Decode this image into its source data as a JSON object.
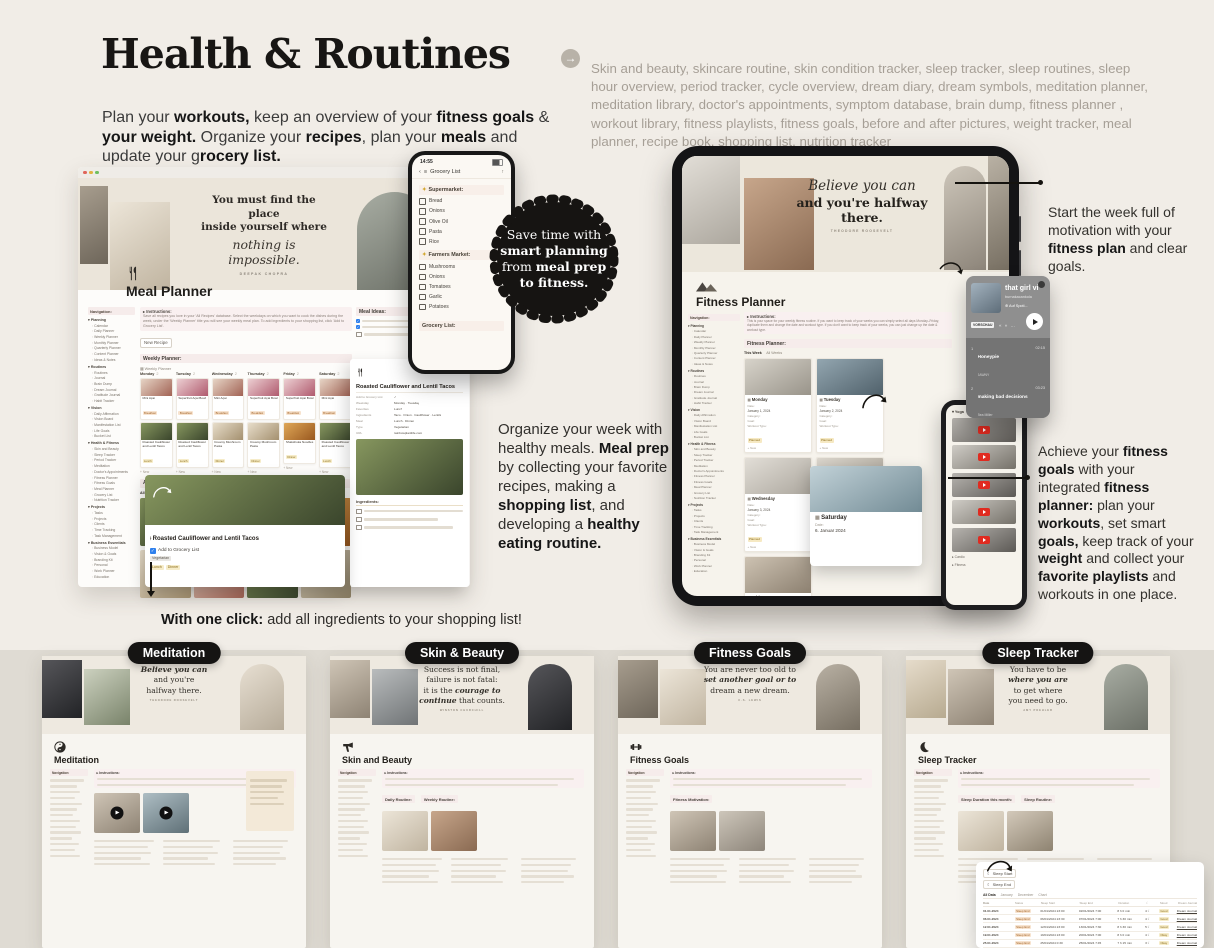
{
  "header": {
    "title": "Health & Routines",
    "arrow_icon": "→",
    "intro": [
      {
        "t": "Plan your ",
        "c": ""
      },
      {
        "t": "workouts,",
        "c": "b"
      },
      {
        "t": " keep an overview of your ",
        "c": ""
      },
      {
        "t": "fitness goals",
        "c": "b"
      },
      {
        "t": " & ",
        "c": ""
      },
      {
        "t": "your weight.",
        "c": "b"
      },
      {
        "t": " Organize your ",
        "c": ""
      },
      {
        "t": "recipes",
        "c": "b"
      },
      {
        "t": ", plan your ",
        "c": ""
      },
      {
        "t": "meals",
        "c": "b"
      },
      {
        "t": " and update your g",
        "c": ""
      },
      {
        "t": "rocery list.",
        "c": "b"
      }
    ],
    "features": "Skin and beauty, skincare routine, skin condition tracker, sleep tracker, sleep routines, sleep hour overview, period tracker, cycle overview, dream diary, dream symbols, meditation planner, meditation library, doctor's appointments, symptom database, brain dump, fitness planner , workout library, fitness playlists, fitness goals, before and after pictures, weight tracker, meal planner, recipe book, shopping list, nutrition tracker"
  },
  "badge": {
    "lines": [
      [
        {
          "t": "Save time with",
          "c": ""
        }
      ],
      [
        {
          "t": "smart planning",
          "c": "b"
        }
      ],
      [
        {
          "t": "from ",
          "c": ""
        },
        {
          "t": "meal prep",
          "c": "b"
        }
      ],
      [
        {
          "t": "to fitness.",
          "c": "b"
        }
      ]
    ]
  },
  "mid_text": [
    {
      "t": "Organize your week with healthy meals. ",
      "c": ""
    },
    {
      "t": "Meal prep",
      "c": "b"
    },
    {
      "t": " by collecting your favorite recipes, making a ",
      "c": ""
    },
    {
      "t": "shopping list",
      "c": "b"
    },
    {
      "t": ", and developing a ",
      "c": ""
    },
    {
      "t": "healthy eating routine.",
      "c": "b"
    }
  ],
  "one_click": [
    {
      "t": "With one click:",
      "c": "b"
    },
    {
      "t": " add all ingredients to your shopping list!",
      "c": ""
    }
  ],
  "right_top": [
    {
      "t": "Start the week full of motivation with your ",
      "c": ""
    },
    {
      "t": "fitness plan",
      "c": "b"
    },
    {
      "t": " and clear goals.",
      "c": ""
    }
  ],
  "right_bottom": [
    {
      "t": "Achieve your ",
      "c": ""
    },
    {
      "t": "fitness goals",
      "c": "b"
    },
    {
      "t": " with your integrated ",
      "c": ""
    },
    {
      "t": "fitness planner:",
      "c": "b"
    },
    {
      "t": " plan your ",
      "c": ""
    },
    {
      "t": "workouts",
      "c": "b"
    },
    {
      "t": ", set smart ",
      "c": ""
    },
    {
      "t": "goals,",
      "c": "b"
    },
    {
      "t": " keep track of your ",
      "c": ""
    },
    {
      "t": "weight",
      "c": "b"
    },
    {
      "t": " and collect your ",
      "c": ""
    },
    {
      "t": "favorite playlists",
      "c": "b"
    },
    {
      "t": " and workouts in one place.",
      "c": ""
    }
  ],
  "phone": {
    "time": "14:55",
    "back_icon": "‹",
    "list_icon": "≡",
    "share_icon": "↑",
    "nav_title": "Grocery List",
    "sections": [
      {
        "icon": "✦",
        "title": "Supermarket:",
        "items": [
          "Bread",
          "Onions",
          "Olive Oil",
          "Pasta",
          "Rice"
        ]
      },
      {
        "icon": "✦",
        "title": "Farmers Market:",
        "items": [
          "Mushrooms",
          "Onions",
          "Tomatoes",
          "Garlic",
          "Potatoes"
        ]
      }
    ],
    "footer": "Grocery List:"
  },
  "meal": {
    "quote": {
      "l1": "You must find the place",
      "l2": "inside yourself where",
      "script": "nothing is impossible.",
      "attr": "DEEPAK CHOPRA"
    },
    "title": "Meal Planner",
    "nav_label": "Navigation:",
    "nav": [
      {
        "group": "Planning",
        "items": [
          "Calendar",
          "Daily Planner",
          "Weekly Planner",
          "Monthly Planner",
          "Quarterly Planner",
          "Content Planner",
          "Ideas & Notes"
        ]
      },
      {
        "group": "Routines",
        "items": [
          "Routines",
          "Journal",
          "Brain Dump",
          "Dream Journal",
          "Gratitude Journal",
          "Habit Tracker"
        ]
      },
      {
        "group": "Vision",
        "items": [
          "Daily Affirmation",
          "Vision Board",
          "Manifestation List",
          "Life Goals",
          "Bucket List"
        ]
      },
      {
        "group": "Health & Fitness",
        "items": [
          "Skin and Beauty",
          "Sleep Tracker",
          "Period Tracker",
          "Meditation",
          "Doctor's Appointments",
          "Fitness Planner",
          "Fitness Goals",
          "Meal Planner",
          "Grocery List",
          "Nutrition Tracker"
        ]
      },
      {
        "group": "Projects",
        "items": [
          "Tasks",
          "Projects",
          "Clients",
          "Time Tracking",
          "Task Management"
        ]
      },
      {
        "group": "Business Essentials",
        "items": [
          "Business Model",
          "Vision & Goals",
          "Branding Kit",
          "Personal",
          "Work Planner",
          "Education"
        ]
      }
    ],
    "instructions": {
      "label": "Instructions:",
      "text": "Save all recipes you love in your 'All Recipes' database. Select the weekdays on which you want to cook the dishes during the week, under the 'Weekly Planner' title you will see your weekly meal plan. To add ingredients to your shopping list, click 'Add to Grocery List'."
    },
    "new_recipe": "New Recipe",
    "weekly_heading": "Weekly Planner:",
    "view": "Weekly Planner",
    "breakfast_tag": "Breakfast",
    "new_item": "+ New",
    "days": [
      {
        "day": "Monday",
        "count": "2",
        "b_title": "Mini Açai",
        "b_img": "acai1",
        "m_title": "Roasted Cauliflower and Lentil Tacos",
        "m_tag": "Lunch",
        "m_img": "taco"
      },
      {
        "day": "Tuesday",
        "count": "2",
        "b_title": "Superfruit Açai Bowl",
        "b_img": "acai2",
        "m_title": "Roasted Cauliflower and Lentil Tacos",
        "m_tag": "Lunch",
        "m_img": "taco"
      },
      {
        "day": "Wednesday",
        "count": "2",
        "b_title": "Mini Açai",
        "b_img": "acai1",
        "m_title": "Creamy Mushroom Pasta",
        "m_tag": "Dinner",
        "m_img": "pasta"
      },
      {
        "day": "Thursday",
        "count": "2",
        "b_title": "Superfruit Açai Bowl",
        "b_img": "acai2",
        "m_title": "Creamy Mushroom Pasta",
        "m_tag": "Dinner",
        "m_img": "pasta"
      },
      {
        "day": "Friday",
        "count": "2",
        "b_title": "Superfruit Açai Bowl",
        "b_img": "acai2",
        "m_title": "Shakshuka Noodles",
        "m_tag": "Dinner",
        "m_img": "curry"
      },
      {
        "day": "Saturday",
        "count": "2",
        "b_title": "Mini Açai",
        "b_img": "acai1",
        "m_title": "Roasted Cauliflower and Lentil Tacos",
        "m_tag": "Lunch",
        "m_img": "taco"
      }
    ],
    "recipes_heading": "All Recipes:",
    "tabs": [
      "All Recipes",
      "Grocery List",
      "Breakfast",
      "Lunch",
      "Dinner",
      "Snack",
      "7 more..."
    ],
    "grid": [
      "taco",
      "mush",
      "tofu",
      "curry",
      "pasta",
      "acai1",
      "taco",
      "mush"
    ],
    "popup": {
      "title": "Roasted Cauliflower and Lentil Tacos",
      "check": "Add to Grocery List",
      "type": "Vegetarian",
      "tags": [
        "Lunch",
        "Dinner"
      ]
    },
    "detail": {
      "title": "Roasted Cauliflower and Lentil Tacos",
      "props": [
        {
          "k": "Add to Grocery List",
          "v": "✓"
        },
        {
          "k": "Weekday",
          "v": "Monday · Tuesday"
        },
        {
          "k": "Favorites",
          "v": "Lunch"
        },
        {
          "k": "Ingredients",
          "v": "Taco · Onion · Cauliflower · Lentils"
        },
        {
          "k": "Meal",
          "v": "Lunch · Dinner"
        },
        {
          "k": "Type",
          "v": "Vegetarian"
        },
        {
          "k": "URL",
          "v": "rainbowplantlife.com"
        }
      ],
      "ingredients": "Ingredients:"
    },
    "rail_heading": "Meal Ideas:"
  },
  "tablet": {
    "quote": {
      "script": "Believe you can",
      "line": "and you're halfway there.",
      "attr": "THEODORE ROOSEVELT"
    },
    "title": "Fitness Planner",
    "instructions": {
      "label": "Instructions:",
      "text": "This is your space for your weekly fitness routine. If you want to keep track of your weeks you can simply select all days Monday–Friday, duplicate them and change the date and workout type. If you don't want to keep track of your weeks, you can just change up the date & workout type."
    },
    "heading": "Fitness Planner:",
    "tabs": [
      "This Week",
      "All Weeks"
    ],
    "labels": {
      "date": "Date:",
      "category": "Category:",
      "goal": "Goal:",
      "workout": "Workout Type:",
      "status": "Planned",
      "new": "+ New"
    },
    "days": [
      {
        "day": "Monday",
        "date": "January 1, 2024",
        "img": "w1"
      },
      {
        "day": "Tuesday",
        "date": "January 2, 2024",
        "img": "w2"
      },
      {
        "day": "Wednesday",
        "date": "January 3, 2024",
        "img": "w3"
      },
      {
        "day": "Thursday",
        "date": "January 4, 2024",
        "img": "w4"
      },
      {
        "day": "Friday",
        "date": "January 5, 2024",
        "img": "w5"
      }
    ],
    "hover": {
      "day": "Saturday",
      "date_label": "Date:",
      "date": "6. Januar 2024",
      "img": "w6"
    },
    "rail_group": "Yoga",
    "videos": [
      "y1",
      "y2",
      "y3",
      "y4",
      "y5"
    ],
    "rail_groups2": [
      "Cardio",
      "Fitness"
    ]
  },
  "spotify": {
    "title": "that girl vi",
    "artist": "burnakacankola",
    "cta": "Auf Spoti...",
    "preview": "VORSCHAU",
    "controls": "« » …",
    "tracks": [
      {
        "n": "1",
        "title": "Honeypie",
        "artist": "JAWNY",
        "time": "02:15"
      },
      {
        "n": "2",
        "title": "making bad decisions",
        "artist": "Bea Miller",
        "time": "03:23"
      },
      {
        "n": "3",
        "title": "Amour plastique",
        "artist": "Videoclub, Adèle Castillon",
        "time": "03:47"
      }
    ]
  },
  "bottom": {
    "cards": [
      {
        "label": "Meditation",
        "title": "Meditation",
        "icon": "yinyang",
        "play": "1",
        "side": "1",
        "sections": [],
        "quote": [
          [
            {
              "t": "Believe you can",
              "c": "bi"
            }
          ],
          [
            {
              "t": "and you're",
              "c": ""
            }
          ],
          [
            {
              "t": "halfway there.",
              "c": ""
            }
          ]
        ],
        "attr": "THEODORE ROOSEVELT",
        "ph": [
          "dark",
          "matcha",
          "selfie"
        ],
        "tiles": [
          "med1",
          "med2"
        ]
      },
      {
        "label": "Skin & Beauty",
        "title": "Skin and Beauty",
        "icon": "dryer",
        "play": "0",
        "side": "0",
        "sections": [
          "Daily Routine:",
          "Weekly Routine:"
        ],
        "quote": [
          [
            {
              "t": "Success is not final,",
              "c": ""
            }
          ],
          [
            {
              "t": "failure is not fatal:",
              "c": ""
            }
          ],
          [
            {
              "t": "it is the ",
              "c": ""
            },
            {
              "t": "courage to",
              "c": "bi"
            }
          ],
          [
            {
              "t": "continue",
              "c": "bi"
            },
            {
              "t": " that counts.",
              "c": ""
            }
          ]
        ],
        "attr": "WINSTON CHURCHILL",
        "ph": [
          "women",
          "laptop",
          "darkfig"
        ],
        "tiles": [
          "skin1",
          "skin2"
        ]
      },
      {
        "label": "Fitness Goals",
        "title": "Fitness Goals",
        "icon": "dumbbell",
        "play": "0",
        "side": "0",
        "sections": [
          "Fitness Motivation:"
        ],
        "quote": [
          [
            {
              "t": "You are never too old to",
              "c": ""
            }
          ],
          [
            {
              "t": "set another goal or to",
              "c": "bi"
            }
          ],
          [
            {
              "t": "dream a new dream.",
              "c": ""
            }
          ]
        ],
        "attr": "C.S. LEWIS",
        "ph": [
          "deskA",
          "bookC",
          "blonde"
        ],
        "tiles": [
          "fit1",
          "fit2"
        ]
      },
      {
        "label": "Sleep Tracker",
        "title": "Sleep Tracker",
        "icon": "moon",
        "play": "0",
        "side": "0",
        "sections": [
          "Sleep Duration this month:",
          "Sleep Routine:"
        ],
        "quote": [
          [
            {
              "t": "You have to be",
              "c": ""
            }
          ],
          [
            {
              "t": "where you are",
              "c": "bi"
            }
          ],
          [
            {
              "t": "to get where",
              "c": ""
            }
          ],
          [
            {
              "t": "you need to go.",
              "c": ""
            }
          ]
        ],
        "attr": "AMY POEHLER",
        "ph": [
          "palm",
          "journal",
          "pin"
        ],
        "tiles": [
          "slp1",
          "slp2"
        ]
      }
    ]
  },
  "sleep_table": {
    "buttons": [
      {
        "icon": "☾",
        "label": "Sleep Start"
      },
      {
        "icon": "☾",
        "label": "Sleep End"
      }
    ],
    "tabs": [
      "All Data",
      "January",
      "December",
      "Chart"
    ],
    "headers": [
      "Date",
      "Status",
      "Sleep Start",
      "Sleep End",
      "Duration",
      "☾",
      "Mood",
      "Dream Journal"
    ],
    "rows": [
      {
        "date": "01.01.2024",
        "tag": "Sleep End",
        "start": "01/01/2024 23:00",
        "end": "02/01/2024 7:00",
        "dur": "8 h 0 min",
        "m": "4 ☾",
        "q": "Good",
        "link": "Dream Journal"
      },
      {
        "date": "06.01.2024",
        "tag": "Sleep End",
        "start": "06/01/2024 23:30",
        "end": "07/01/2024 7:00",
        "dur": "7 h 30 min",
        "m": "4 ☾",
        "q": "Good",
        "link": "Dream Journal"
      },
      {
        "date": "12.01.2024",
        "tag": "Sleep End",
        "start": "12/01/2024 23:00",
        "end": "13/01/2024 7:30",
        "dur": "8 h 30 min",
        "m": "5 ☾",
        "q": "Good",
        "link": "Dream Journal"
      },
      {
        "date": "19.01.2024",
        "tag": "Sleep End",
        "start": "19/01/2024 23:00",
        "end": "20/01/2024 7:00",
        "dur": "8 h 0 min",
        "m": "4 ☾",
        "q": "Okay",
        "link": "Dream Journal"
      },
      {
        "date": "25.01.2024",
        "tag": "Sleep End",
        "start": "25/01/2024 0:30",
        "end": "25/01/2024 7:45",
        "dur": "7 h 15 min",
        "m": "3 ☾",
        "q": "Okay",
        "link": "Dream Journal"
      }
    ]
  }
}
